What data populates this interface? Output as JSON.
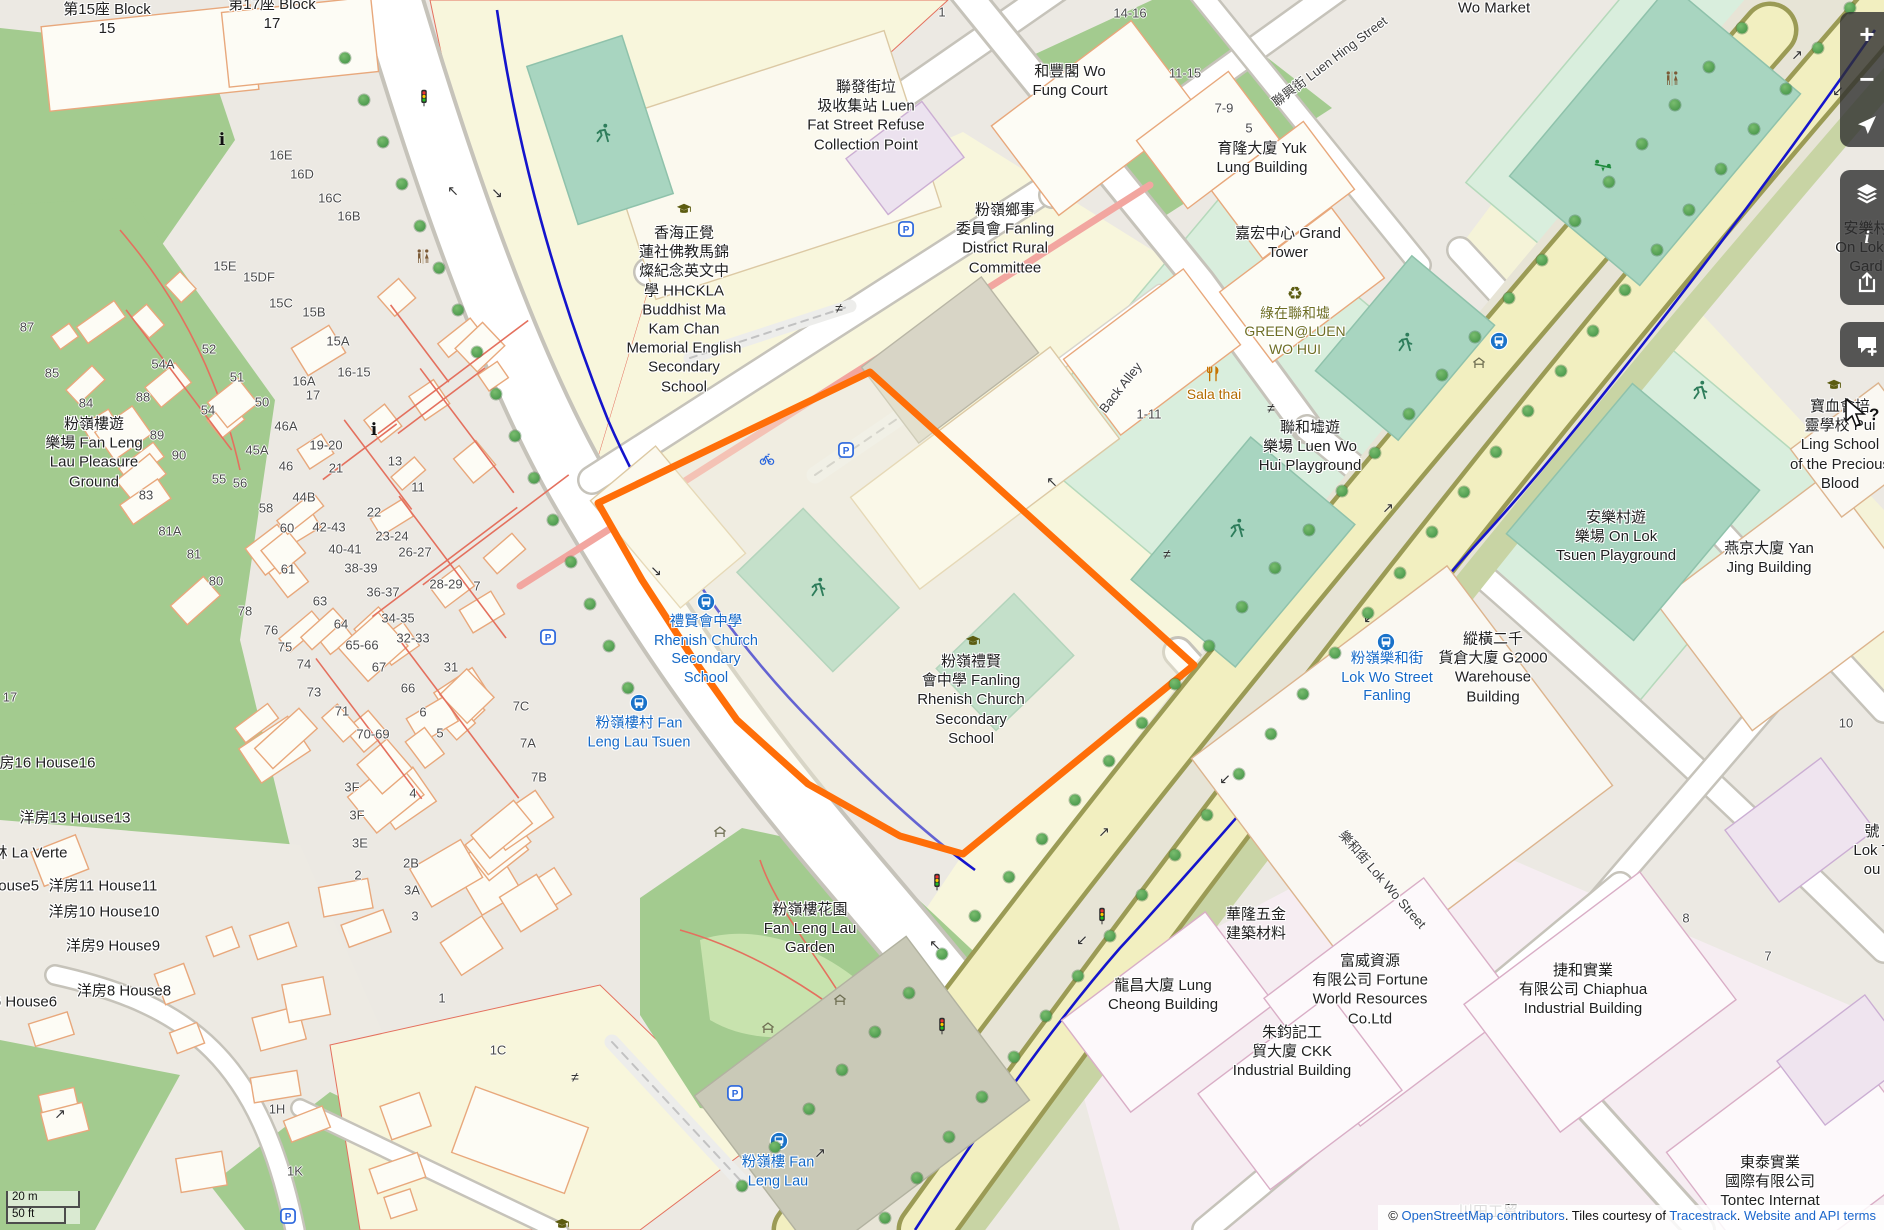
{
  "map": {
    "region": "Fanling, Luen Wo Hui",
    "highlight_color": "#ff6e08"
  },
  "scale": {
    "metric": "20 m",
    "imperial": "50 ft"
  },
  "attribution": {
    "copyright": "© ",
    "osm_link": "OpenStreetMap contributors",
    "middle": ". Tiles courtesy of ",
    "tiles_link": "Tracestrack",
    "dot": ". ",
    "terms_link": "Website and API terms"
  },
  "controls": [
    {
      "n": "zoom-in",
      "icon": "plus",
      "g": "+",
      "group": 1
    },
    {
      "n": "zoom-out",
      "icon": "minus",
      "g": "−",
      "group": 1
    },
    {
      "n": "navigate",
      "icon": "nav",
      "g": "",
      "group": 1
    },
    {
      "n": "layers",
      "icon": "layers",
      "g": "",
      "group": 2
    },
    {
      "n": "map-info",
      "icon": "info",
      "g": "i",
      "group": 2
    },
    {
      "n": "share",
      "icon": "share",
      "g": "",
      "group": 2
    },
    {
      "n": "add-note",
      "icon": "comment",
      "g": "",
      "group": 3
    }
  ],
  "labels": [
    {
      "n": "block-15",
      "c": "",
      "x": 107,
      "y": 19,
      "l": [
        "第15座 Block",
        "15"
      ]
    },
    {
      "n": "block-17",
      "c": "",
      "x": 272,
      "y": 14,
      "l": [
        "第17座 Block",
        "17"
      ]
    },
    {
      "n": "wo-market",
      "c": "",
      "x": 1494,
      "y": 8,
      "l": [
        "Wo Market"
      ]
    },
    {
      "n": "wo-fung-court",
      "c": "",
      "x": 1070,
      "y": 81,
      "l": [
        "和豐閣 Wo",
        "Fung Court"
      ]
    },
    {
      "n": "yuk-lung-building",
      "c": "",
      "x": 1262,
      "y": 158,
      "l": [
        "育隆大廈 Yuk",
        "Lung Building"
      ]
    },
    {
      "n": "luen-hing-street",
      "c": "street",
      "x": 1330,
      "y": 62,
      "r": -37,
      "l": [
        "聯興街 Luen Hing Street"
      ]
    },
    {
      "n": "refuse-collection-point",
      "c": "",
      "x": 866,
      "y": 116,
      "l": [
        "聯發街垃",
        "圾收集站 Luen",
        "Fat Street Refuse",
        "Collection Point"
      ]
    },
    {
      "n": "rural-committee",
      "c": "",
      "x": 1005,
      "y": 239,
      "l": [
        "粉嶺鄉事",
        "委員會 Fanling",
        "District Rural",
        "Committee"
      ]
    },
    {
      "n": "grand-tower",
      "c": "",
      "x": 1288,
      "y": 243,
      "l": [
        "嘉宏中心 Grand",
        "Tower"
      ]
    },
    {
      "n": "green-luen-wo-hui",
      "c": "green",
      "x": 1295,
      "y": 332,
      "l": [
        "綠在聯和墟",
        "GREEN@LUEN",
        "WO HUI"
      ]
    },
    {
      "n": "hhckla-school",
      "c": "",
      "x": 684,
      "y": 310,
      "l": [
        "香海正覺",
        "蓮社佛教馬錦",
        "燦紀念英文中",
        "學 HHCKLA",
        "Buddhist Ma",
        "Kam Chan",
        "Memorial English",
        "Secondary",
        "School"
      ]
    },
    {
      "n": "back-alley",
      "c": "street",
      "x": 1121,
      "y": 388,
      "r": -52,
      "l": [
        "Back Alley"
      ]
    },
    {
      "n": "sala-thai",
      "c": "poi",
      "x": 1214,
      "y": 395,
      "l": [
        "Sala thai"
      ]
    },
    {
      "n": "luen-wo-hui-playground",
      "c": "",
      "x": 1310,
      "y": 447,
      "l": [
        "聯和墟遊",
        "樂場 Luen Wo",
        "Hui Playground"
      ]
    },
    {
      "n": "on-lok-garden",
      "c": "",
      "x": 1866,
      "y": 248,
      "l": [
        "安樂村",
        "On Lok T",
        "Gard"
      ]
    },
    {
      "n": "pui-ling-school",
      "c": "",
      "x": 1840,
      "y": 445,
      "l": [
        "寶血會培",
        "靈學校 Pui",
        "Ling School",
        "of the Precious",
        "Blood"
      ]
    },
    {
      "n": "on-lok-tsuen-playground",
      "c": "",
      "x": 1616,
      "y": 537,
      "l": [
        "安樂村遊",
        "樂場 On Lok",
        "Tsuen Playground"
      ]
    },
    {
      "n": "yan-jing-building",
      "c": "",
      "x": 1769,
      "y": 558,
      "l": [
        "燕京大廈 Yan",
        "Jing Building"
      ]
    },
    {
      "n": "g2000-warehouse",
      "c": "",
      "x": 1493,
      "y": 668,
      "l": [
        "縱橫二千",
        "貨倉大廈 G2000",
        "Warehouse",
        "Building"
      ]
    },
    {
      "n": "lok-wo-street-fanling-stop",
      "c": "transit",
      "x": 1387,
      "y": 678,
      "l": [
        "粉嶺樂和街",
        "Lok Wo Street",
        "Fanling"
      ]
    },
    {
      "n": "rhenish-church-stop",
      "c": "transit",
      "x": 706,
      "y": 650,
      "l": [
        "禮賢會中學",
        "Rhenish Church",
        "Secondary",
        "School"
      ]
    },
    {
      "n": "fan-leng-lau-tsuen-stop",
      "c": "transit",
      "x": 639,
      "y": 733,
      "l": [
        "粉嶺樓村 Fan",
        "Leng Lau Tsuen"
      ]
    },
    {
      "n": "fanling-rhenish-school",
      "c": "",
      "x": 971,
      "y": 700,
      "l": [
        "粉嶺禮賢",
        "會中學 Fanling",
        "Rhenish Church",
        "Secondary",
        "School"
      ]
    },
    {
      "n": "fan-leng-lau-pleasure-ground",
      "c": "",
      "x": 94,
      "y": 453,
      "l": [
        "粉嶺樓遊",
        "樂場 Fan Leng",
        "Lau Pleasure",
        "Ground"
      ]
    },
    {
      "n": "fan-leng-lau-garden",
      "c": "",
      "x": 810,
      "y": 929,
      "l": [
        "粉嶺樓花園",
        "Fan Leng Lau",
        "Garden"
      ]
    },
    {
      "n": "fan-leng-lau-stop",
      "c": "transit",
      "x": 778,
      "y": 1172,
      "l": [
        "粉嶺樓 Fan",
        "Leng Lau"
      ]
    },
    {
      "n": "lok-wo-street",
      "c": "street",
      "x": 1382,
      "y": 880,
      "r": 49,
      "l": [
        "樂和街 Lok Wo Street"
      ]
    },
    {
      "n": "wah-lung-hardware",
      "c": "",
      "x": 1256,
      "y": 924,
      "l": [
        "華隆五金",
        "建築材料"
      ]
    },
    {
      "n": "fortune-world-resources",
      "c": "",
      "x": 1370,
      "y": 990,
      "l": [
        "富威資源",
        "有限公司 Fortune",
        "World Resources",
        "Co.Ltd"
      ]
    },
    {
      "n": "lung-cheong-building",
      "c": "",
      "x": 1163,
      "y": 995,
      "l": [
        "龍昌大廈 Lung",
        "Cheong Building"
      ]
    },
    {
      "n": "ckk-industrial-building",
      "c": "",
      "x": 1292,
      "y": 1052,
      "l": [
        "朱鈞記工",
        "貿大廈 CKK",
        "Industrial Building"
      ]
    },
    {
      "n": "chiaphua-industrial-building",
      "c": "",
      "x": 1583,
      "y": 990,
      "l": [
        "捷和實業",
        "有限公司 Chiaphua",
        "Industrial Building"
      ]
    },
    {
      "n": "tontec-international",
      "c": "",
      "x": 1770,
      "y": 1182,
      "l": [
        "東泰實業",
        "國際有限公司",
        "Tontec Internat"
      ]
    },
    {
      "n": "chuen-tin",
      "c": "",
      "x": 1488,
      "y": 1212,
      "l": [
        "川田工貿"
      ]
    },
    {
      "n": "lok-tsuen-partial",
      "c": "",
      "x": 1872,
      "y": 851,
      "l": [
        "號",
        "Lok T",
        "ou"
      ]
    },
    {
      "n": "house16",
      "c": "",
      "x": 40,
      "y": 763,
      "l": [
        "洋房16 House16"
      ]
    },
    {
      "n": "house13",
      "c": "",
      "x": 75,
      "y": 818,
      "l": [
        "洋房13 House13"
      ]
    },
    {
      "n": "la-verte",
      "c": "",
      "x": 30,
      "y": 853,
      "l": [
        "林 La Verte"
      ]
    },
    {
      "n": "house5",
      "c": "",
      "x": -8,
      "y": 886,
      "l": [
        "洋房5 House5"
      ]
    },
    {
      "n": "house11",
      "c": "",
      "x": 103,
      "y": 886,
      "l": [
        "洋房11 House11"
      ]
    },
    {
      "n": "house10",
      "c": "",
      "x": 104,
      "y": 912,
      "l": [
        "洋房10 House10"
      ]
    },
    {
      "n": "house9",
      "c": "",
      "x": 113,
      "y": 946,
      "l": [
        "洋房9 House9"
      ]
    },
    {
      "n": "house8",
      "c": "",
      "x": 124,
      "y": 991,
      "l": [
        "洋房8 House8"
      ]
    },
    {
      "n": "house6",
      "c": "",
      "x": 10,
      "y": 1002,
      "l": [
        "洋房6 House6"
      ]
    }
  ],
  "house_numbers": [
    [
      "14-16",
      1130,
      13
    ],
    [
      "11-15",
      1185,
      73
    ],
    [
      "7-9",
      1224,
      108
    ],
    [
      "5",
      1249,
      128
    ],
    [
      "1",
      942,
      12
    ],
    [
      "87",
      27,
      327
    ],
    [
      "85",
      52,
      373
    ],
    [
      "84",
      86,
      403
    ],
    [
      "88",
      143,
      397
    ],
    [
      "89",
      157,
      435
    ],
    [
      "90",
      179,
      455
    ],
    [
      "83",
      146,
      495
    ],
    [
      "81A",
      170,
      531
    ],
    [
      "81",
      194,
      554
    ],
    [
      "80",
      216,
      581
    ],
    [
      "78",
      245,
      611
    ],
    [
      "76",
      271,
      630
    ],
    [
      "75",
      285,
      647
    ],
    [
      "74",
      304,
      664
    ],
    [
      "73",
      314,
      692
    ],
    [
      "71",
      342,
      711
    ],
    [
      "70-69",
      373,
      734
    ],
    [
      "67",
      379,
      667
    ],
    [
      "66",
      408,
      688
    ],
    [
      "6",
      423,
      712
    ],
    [
      "5",
      440,
      733
    ],
    [
      "65-66",
      362,
      645
    ],
    [
      "64",
      341,
      624
    ],
    [
      "63",
      320,
      601
    ],
    [
      "61",
      288,
      569
    ],
    [
      "60",
      287,
      528
    ],
    [
      "58",
      266,
      508
    ],
    [
      "56",
      240,
      483
    ],
    [
      "55",
      219,
      479
    ],
    [
      "54",
      208,
      410
    ],
    [
      "54A",
      163,
      364
    ],
    [
      "52",
      209,
      349
    ],
    [
      "51",
      237,
      377
    ],
    [
      "50",
      262,
      402
    ],
    [
      "46A",
      286,
      426
    ],
    [
      "46",
      286,
      466
    ],
    [
      "45A",
      257,
      450
    ],
    [
      "44B",
      304,
      497
    ],
    [
      "42-43",
      329,
      527
    ],
    [
      "40-41",
      345,
      549
    ],
    [
      "38-39",
      361,
      568
    ],
    [
      "36-37",
      383,
      592
    ],
    [
      "34-35",
      398,
      618
    ],
    [
      "32-33",
      413,
      638
    ],
    [
      "31",
      451,
      667
    ],
    [
      "28-29",
      446,
      584
    ],
    [
      "26-27",
      415,
      552
    ],
    [
      "23-24",
      392,
      536
    ],
    [
      "22",
      374,
      512
    ],
    [
      "21",
      336,
      468
    ],
    [
      "19-20",
      326,
      445
    ],
    [
      "17",
      313,
      395
    ],
    [
      "16A",
      304,
      381
    ],
    [
      "16-15",
      354,
      372
    ],
    [
      "15A",
      338,
      341
    ],
    [
      "15B",
      314,
      312
    ],
    [
      "15C",
      281,
      303
    ],
    [
      "15DF",
      259,
      277
    ],
    [
      "15E",
      225,
      266
    ],
    [
      "16B",
      349,
      216
    ],
    [
      "16C",
      330,
      198
    ],
    [
      "16D",
      302,
      174
    ],
    [
      "16E",
      281,
      155
    ],
    [
      "13",
      395,
      461
    ],
    [
      "11",
      418,
      487
    ],
    [
      "7",
      477,
      586
    ],
    [
      "17",
      10,
      697
    ],
    [
      "3F",
      352,
      787
    ],
    [
      "3F",
      357,
      815
    ],
    [
      "3E",
      360,
      843
    ],
    [
      "4",
      413,
      793
    ],
    [
      "2",
      358,
      875
    ],
    [
      "2B",
      411,
      863
    ],
    [
      "3A",
      412,
      890
    ],
    [
      "3",
      415,
      916
    ],
    [
      "7C",
      521,
      706
    ],
    [
      "7A",
      528,
      743
    ],
    [
      "7B",
      539,
      777
    ],
    [
      "1H",
      277,
      1109
    ],
    [
      "1K",
      295,
      1171
    ],
    [
      "1C",
      498,
      1050
    ],
    [
      "1",
      442,
      998
    ],
    [
      "10",
      1846,
      723
    ],
    [
      "8",
      1686,
      918
    ],
    [
      "7",
      1768,
      956
    ],
    [
      "1-11",
      1149,
      414
    ]
  ],
  "icons": [
    [
      "bus",
      706,
      602
    ],
    [
      "bus",
      639,
      703
    ],
    [
      "bus",
      779,
      1141
    ],
    [
      "bus",
      1386,
      642
    ],
    [
      "bus",
      1499,
      341
    ],
    [
      "parking",
      906,
      229
    ],
    [
      "parking",
      846,
      450
    ],
    [
      "parking",
      548,
      637
    ],
    [
      "parking",
      735,
      1093
    ],
    [
      "parking",
      288,
      1216
    ],
    [
      "parking-bicycle",
      767,
      459
    ],
    [
      "toilets",
      423,
      257
    ],
    [
      "toilets",
      1672,
      79
    ],
    [
      "recycling",
      1295,
      294
    ],
    [
      "restaurant",
      1213,
      374
    ],
    [
      "runner",
      603,
      133
    ],
    [
      "runner",
      818,
      587
    ],
    [
      "runner",
      1405,
      342
    ],
    [
      "runner",
      1237,
      528
    ],
    [
      "runner",
      1700,
      390
    ],
    [
      "seesaw",
      1603,
      165
    ],
    [
      "school",
      684,
      209
    ],
    [
      "school",
      973,
      641
    ],
    [
      "school",
      1834,
      385
    ],
    [
      "school",
      562,
      1224
    ],
    [
      "shelter",
      720,
      832
    ],
    [
      "shelter",
      840,
      1000
    ],
    [
      "shelter",
      768,
      1028
    ],
    [
      "shelter",
      1479,
      363
    ],
    [
      "traffic-signal",
      424,
      98
    ],
    [
      "traffic-signal",
      937,
      882
    ],
    [
      "traffic-signal",
      1102,
      916
    ],
    [
      "traffic-signal",
      942,
      1026
    ],
    [
      "info",
      222,
      140
    ],
    [
      "info",
      374,
      430
    ],
    [
      "crossing",
      839,
      308
    ],
    [
      "crossing",
      1271,
      408
    ],
    [
      "crossing",
      1167,
      554
    ],
    [
      "crossing",
      575,
      1077
    ],
    [
      "arrow",
      1797,
      55,
      "↗"
    ],
    [
      "arrow",
      1838,
      91,
      "↙"
    ],
    [
      "arrow",
      1388,
      508,
      "↗"
    ],
    [
      "arrow",
      1369,
      618,
      "↙"
    ],
    [
      "arrow",
      1104,
      832,
      "↗"
    ],
    [
      "arrow",
      1225,
      779,
      "↙"
    ],
    [
      "arrow",
      1082,
      940,
      "↙"
    ],
    [
      "arrow",
      820,
      1153,
      "↗"
    ],
    [
      "arrow",
      935,
      945,
      "↖"
    ],
    [
      "arrow",
      453,
      191,
      "↖"
    ],
    [
      "arrow",
      497,
      193,
      "↘"
    ],
    [
      "arrow",
      656,
      571,
      "↘"
    ],
    [
      "arrow",
      1052,
      482,
      "↖"
    ],
    [
      "arrow",
      60,
      1114,
      "↗"
    ]
  ]
}
